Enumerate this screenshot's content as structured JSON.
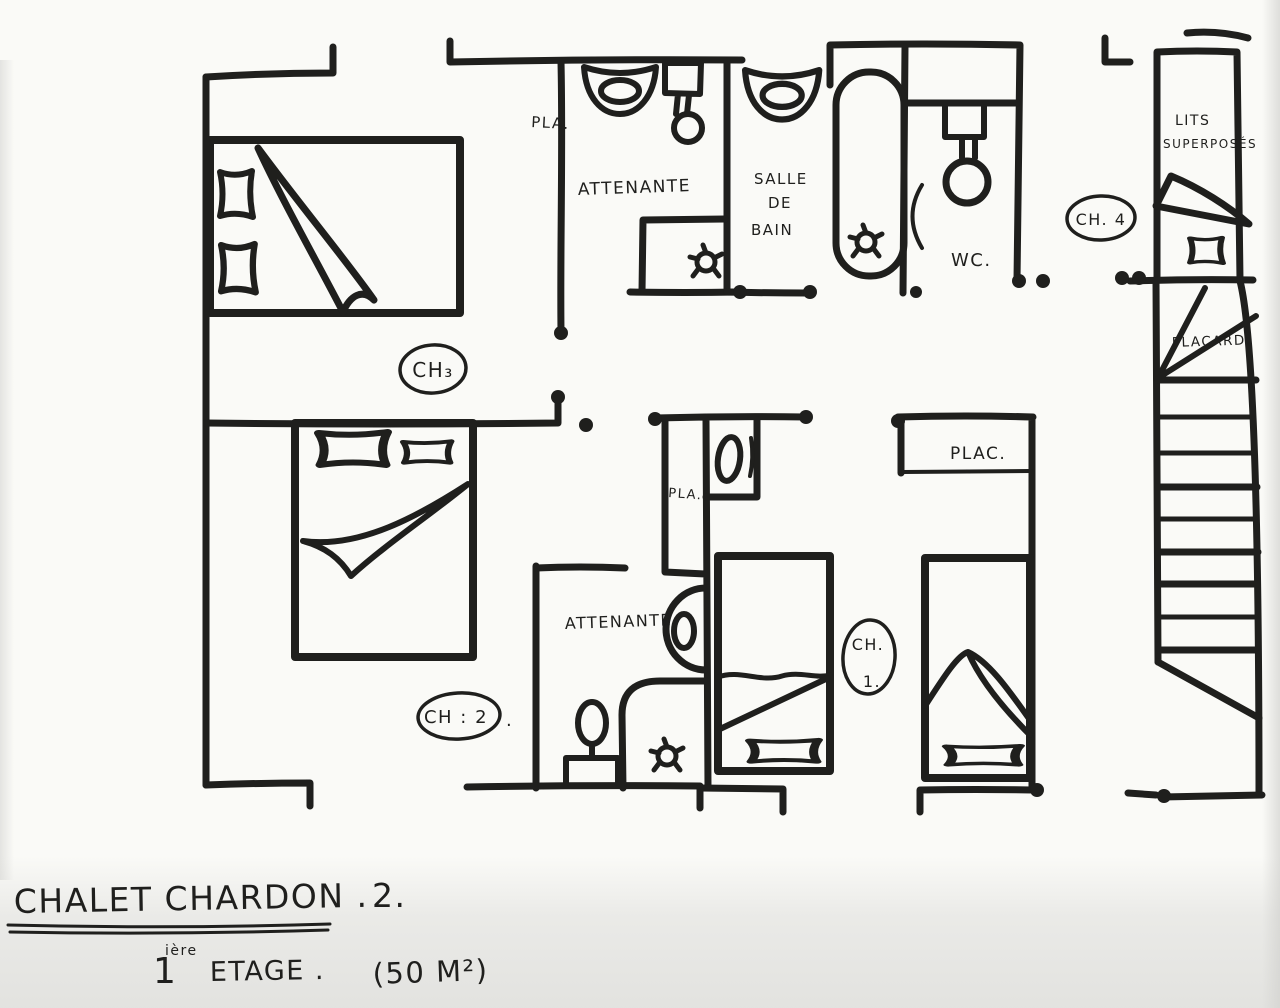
{
  "colors": {
    "ink": "#1f1f1d",
    "paper": "#fafaf7"
  },
  "footer": {
    "title_main": "CHALET CHARDON .",
    "title_number": "2.",
    "floor_digit": "1",
    "floor_sup": "ière",
    "floor_word": "ETAGE .",
    "area": "(50 M²)"
  },
  "rooms": {
    "ch3": "CH₃",
    "ch2": "CH : 2",
    "ch2_dot": ".",
    "ch1_line1": "CH.",
    "ch1_line2": "1.",
    "ch4": "CH. 4",
    "ensuite_top": "ATTENANTE",
    "ensuite_bottom": "ATTENANTE",
    "sdb_line1": "SALLE",
    "sdb_line2": "DE",
    "sdb_line3": "BAIN",
    "wc": "WC.",
    "bunks_line1": "LITS",
    "bunks_line2": "SUPERPOSÉS",
    "stairs_placard": "PLACARD.",
    "closet_top": "PLA.",
    "closet_mid": "PLA.",
    "closet_ch1": "PLAC."
  }
}
